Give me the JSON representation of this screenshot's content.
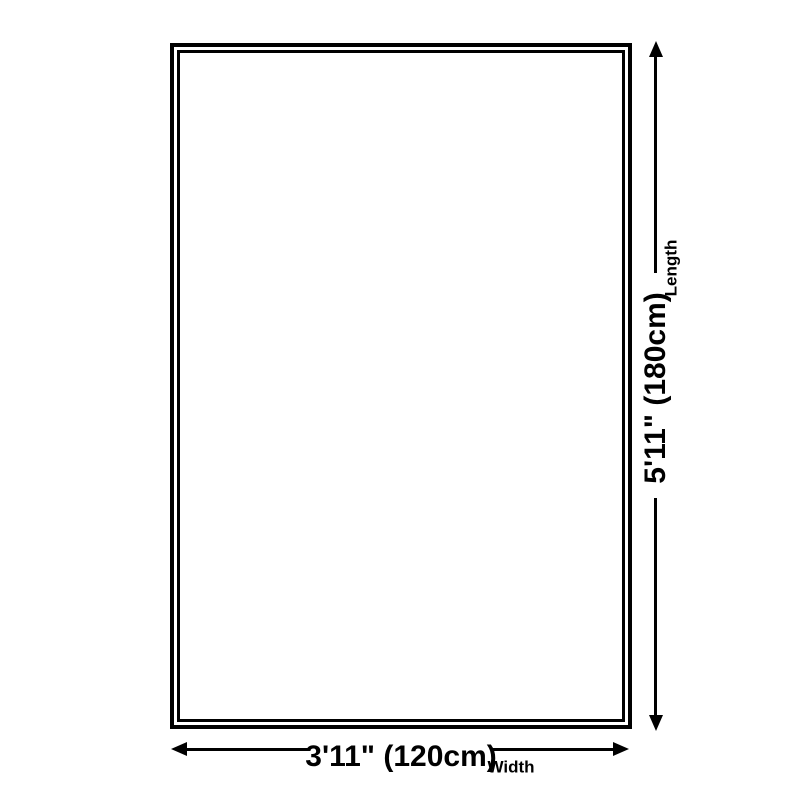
{
  "diagram": {
    "type": "product-dimension-diagram",
    "colors": {
      "line": "#000000",
      "background": "#ffffff"
    },
    "width_dimension": {
      "value": "3'11\" (120cm)",
      "label": "Width"
    },
    "length_dimension": {
      "value": "5'11\" (180cm)",
      "label": "Length"
    }
  }
}
